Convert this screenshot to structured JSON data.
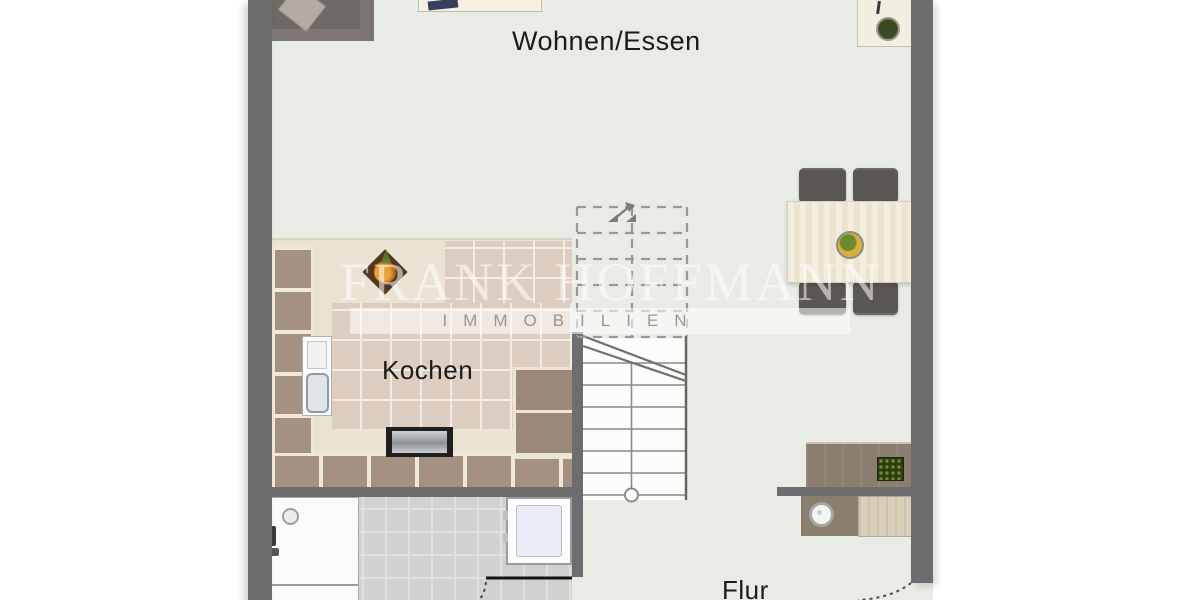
{
  "plan": {
    "type": "floor-plan",
    "floor_shown": "ground floor apartment section"
  },
  "rooms": {
    "living_dining": {
      "label": "Wohnen/Essen"
    },
    "kitchen": {
      "label": "Kochen"
    },
    "hallway": {
      "label": "Flur"
    }
  },
  "watermark": {
    "company": "FRANK HOFFMANN",
    "division": "IMMOBILIEN"
  },
  "furniture_icons": [
    "sofa",
    "media-sideboard",
    "desk",
    "desk-plant",
    "dining-table",
    "dining-chair",
    "fruit-bowl",
    "kitchen-counter",
    "kitchen-sink",
    "dishwasher",
    "kitchen-plant",
    "staircase",
    "stair-direction-arrow",
    "shower",
    "washing-machine",
    "hall-sideboard",
    "planter-box",
    "decor-bowl",
    "door-swing-arc"
  ],
  "colors": {
    "wall": "#6d6d70",
    "floor": "#e9ebe5",
    "exterior": "#ffffff",
    "kitchen_counter": "#a59181",
    "kitchen_counter_dark": "#9b8878",
    "kitchen_floor_tile": "#dccdc0",
    "kitchen_cream": "#eae3d3",
    "bath_tile": "#d1d1cf",
    "furniture_dark": "#5b5752",
    "wood_taupe": "#8c7e6f",
    "wood_light": "#d8cfba",
    "stair_line": "#8a8a88",
    "label_text": "#1b1b1c",
    "watermark_white": "rgba(255,255,255,0.55)"
  }
}
